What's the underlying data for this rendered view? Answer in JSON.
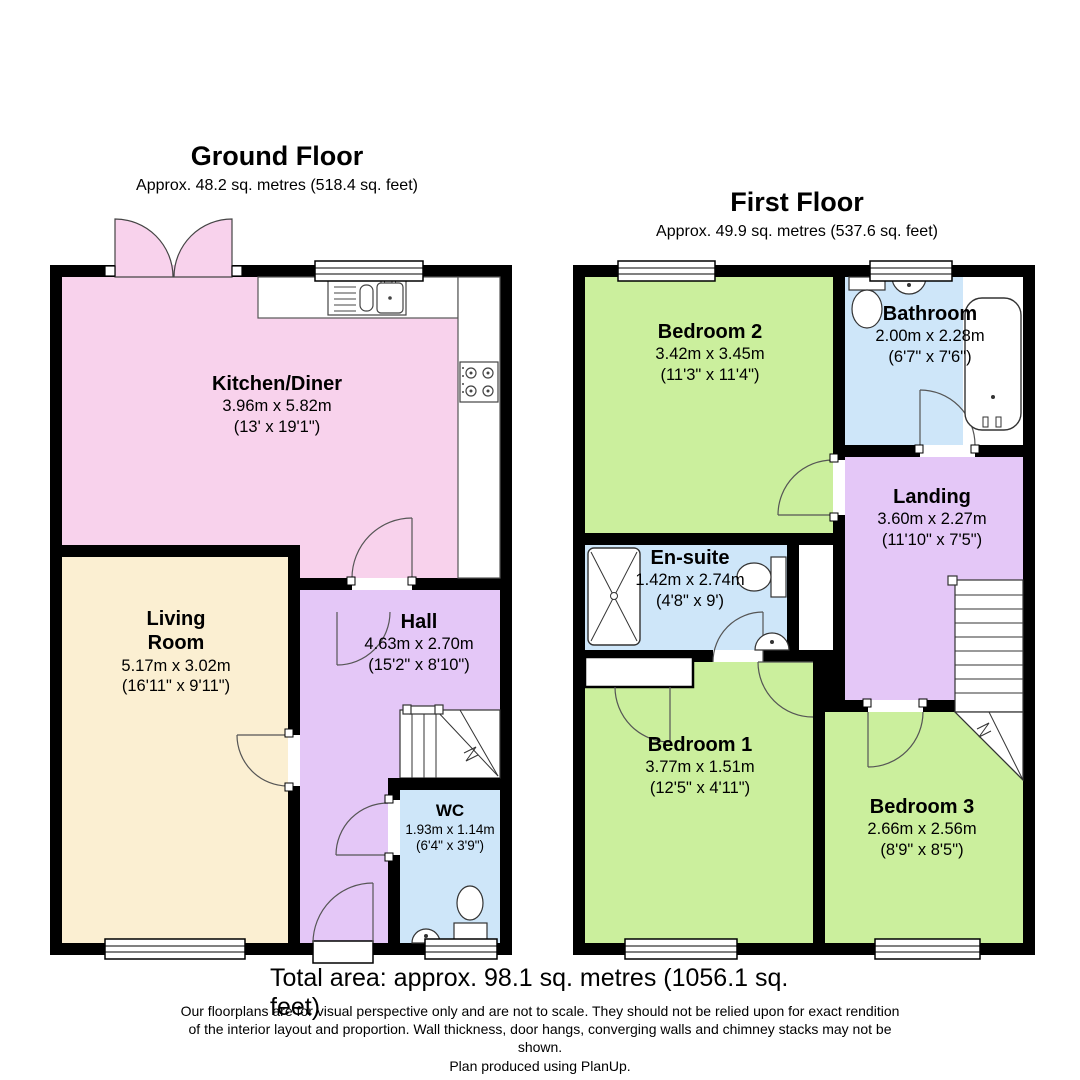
{
  "floors": [
    {
      "title": "Ground Floor",
      "subtitle": "Approx. 48.2 sq. metres (518.4 sq. feet)",
      "rooms": [
        {
          "name": "Kitchen/Diner",
          "metric": "3.96m x 5.82m",
          "imperial": "(13' x 19'1\")"
        },
        {
          "name": "Living Room",
          "metric": "5.17m x 3.02m",
          "imperial": "(16'11\" x 9'11\")"
        },
        {
          "name": "Hall",
          "metric": "4.63m x 2.70m",
          "imperial": "(15'2\" x 8'10\")"
        },
        {
          "name": "WC",
          "metric": "1.93m x 1.14m",
          "imperial": "(6'4\" x 3'9\")"
        }
      ]
    },
    {
      "title": "First Floor",
      "subtitle": "Approx. 49.9 sq. metres (537.6 sq. feet)",
      "rooms": [
        {
          "name": "Bedroom 2",
          "metric": "3.42m x 3.45m",
          "imperial": "(11'3\" x 11'4\")"
        },
        {
          "name": "Bathroom",
          "metric": "2.00m x 2.28m",
          "imperial": "(6'7\" x 7'6\")"
        },
        {
          "name": "Landing",
          "metric": "3.60m x 2.27m",
          "imperial": "(11'10\" x 7'5\")"
        },
        {
          "name": "En-suite",
          "metric": "1.42m x 2.74m",
          "imperial": "(4'8\" x 9')"
        },
        {
          "name": "Bedroom 1",
          "metric": "3.77m x 1.51m",
          "imperial": "(12'5\" x 4'11\")"
        },
        {
          "name": "Bedroom 3",
          "metric": "2.66m x 2.56m",
          "imperial": "(8'9\" x 8'5\")"
        }
      ]
    }
  ],
  "footer": {
    "total": "Total area: approx. 98.1 sq. metres (1056.1 sq. feet)",
    "disclaimer": "Our floorplans are for visual perspective only and are not to scale.  They should not be relied upon for exact rendition of the interior layout and proportion.  Wall thickness, door hangs, converging walls and chimney stacks may not be shown.",
    "credit": "Plan produced using PlanUp."
  },
  "colors": {
    "wall": "#000000",
    "kitchen": "#f8d2ec",
    "living": "#fbefd2",
    "hall": "#e4c7f7",
    "wet": "#cee6f9",
    "bedroom": "#cbef9d"
  }
}
